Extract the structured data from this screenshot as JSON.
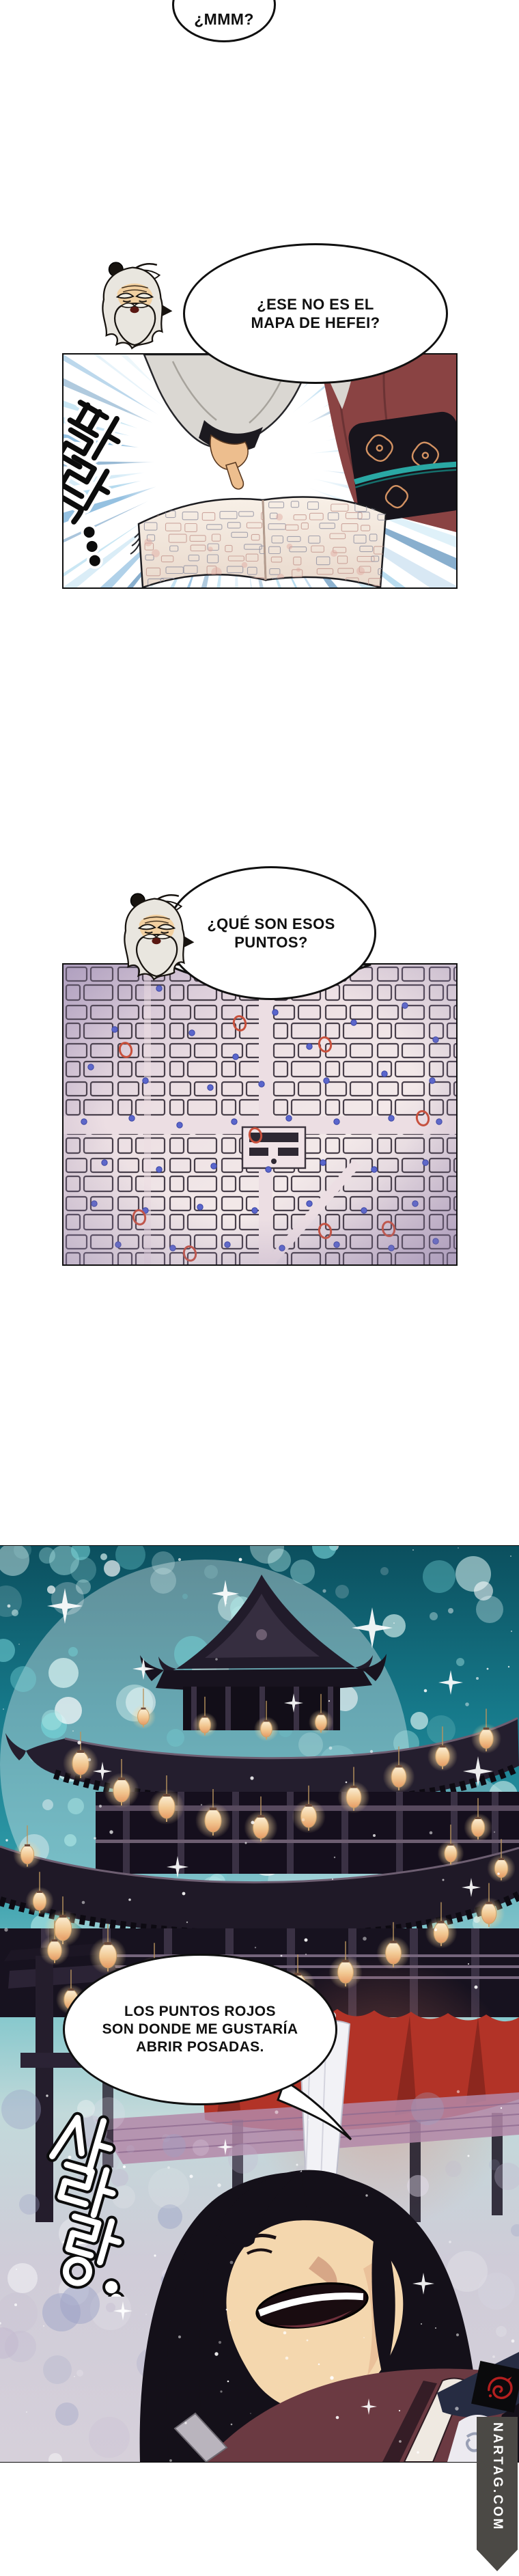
{
  "page": {
    "kind": "webtoon-comic-page",
    "language": "es"
  },
  "dialogue": {
    "bubble_mmm": {
      "text": "¿MMM?"
    },
    "bubble_map": {
      "line1": "¿ESE NO ES EL",
      "line2": "MAPA DE HEFEI?"
    },
    "bubble_dots": {
      "line1": "¿QUÉ SON ESOS",
      "line2": "PUNTOS?"
    },
    "bubble_answer": {
      "line1": "LOS PUNTOS ROJOS",
      "line2": "SON DONDE ME GUSTARÍA",
      "line3": "ABRIR POSADAS."
    }
  },
  "sfx": {
    "page_flip": "팔락...",
    "laugh_sparkle": "사라랑..."
  },
  "watermark": {
    "text": "NARTAG.COM"
  },
  "map": {
    "red_circle_color": "#c8503c",
    "blue_dot_color": "#5a66cc",
    "red_circles": [
      [
        258,
        86
      ],
      [
        383,
        117
      ],
      [
        91,
        125
      ],
      [
        281,
        250
      ],
      [
        526,
        225
      ],
      [
        111,
        370
      ],
      [
        476,
        387
      ],
      [
        185,
        423
      ],
      [
        383,
        390
      ]
    ],
    "blue_dots": [
      [
        140,
        35
      ],
      [
        75,
        95
      ],
      [
        188,
        100
      ],
      [
        252,
        135
      ],
      [
        310,
        70
      ],
      [
        360,
        120
      ],
      [
        425,
        85
      ],
      [
        500,
        60
      ],
      [
        545,
        110
      ],
      [
        40,
        150
      ],
      [
        120,
        170
      ],
      [
        215,
        180
      ],
      [
        290,
        175
      ],
      [
        385,
        170
      ],
      [
        470,
        160
      ],
      [
        540,
        170
      ],
      [
        30,
        230
      ],
      [
        100,
        225
      ],
      [
        170,
        235
      ],
      [
        250,
        230
      ],
      [
        330,
        225
      ],
      [
        400,
        230
      ],
      [
        480,
        225
      ],
      [
        550,
        230
      ],
      [
        60,
        290
      ],
      [
        140,
        300
      ],
      [
        220,
        295
      ],
      [
        300,
        300
      ],
      [
        380,
        290
      ],
      [
        455,
        300
      ],
      [
        530,
        290
      ],
      [
        45,
        350
      ],
      [
        120,
        360
      ],
      [
        200,
        355
      ],
      [
        280,
        360
      ],
      [
        360,
        350
      ],
      [
        440,
        360
      ],
      [
        515,
        350
      ],
      [
        80,
        410
      ],
      [
        160,
        415
      ],
      [
        240,
        410
      ],
      [
        320,
        415
      ],
      [
        400,
        410
      ],
      [
        480,
        415
      ],
      [
        545,
        405
      ]
    ]
  },
  "colors": {
    "sky_teal": "#2f9aa8",
    "lantern": "#f2c892",
    "banner_red": "#b23327",
    "robe_maroon": "#6b3a42",
    "map_bg": "#ecdfe3"
  }
}
